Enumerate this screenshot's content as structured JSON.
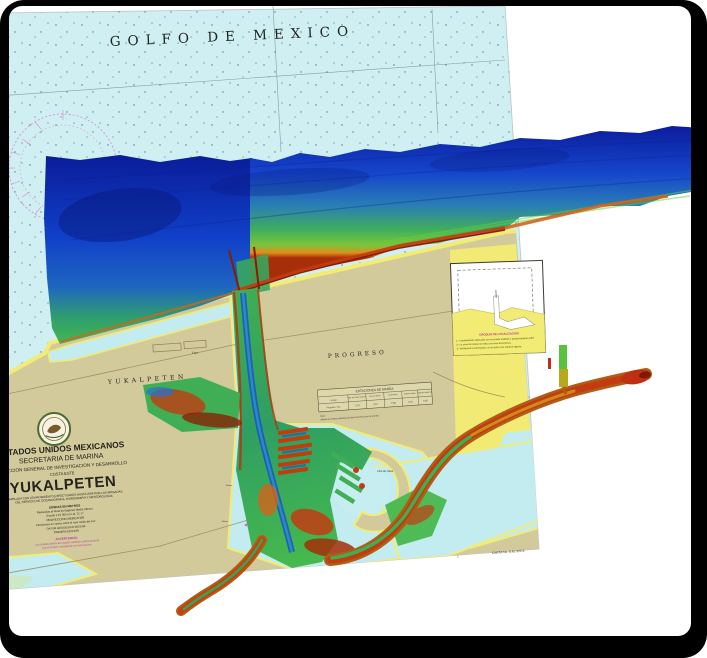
{
  "map": {
    "sea_label": "GOLFO DE MEXICO",
    "labels": {
      "yukalpeten": "YUKALPETEN",
      "progreso": "PROGRESO",
      "faro": "Faro",
      "club": "Club de Yates",
      "baliza1": "Baliza",
      "baliza2": "Baliza"
    },
    "title_block": {
      "country": "ESTADOS UNIDOS MEXICANOS",
      "agency": "SECRETARIA  DE  MARINA",
      "directorate": "DIRECCION GENERAL DE INVESTIGACION Y DESARROLLO",
      "region": "COSTA ESTE",
      "title": "YUKALPETEN",
      "subtitle1": "COMPILADA CON LEVANTAMIENTOS EFECTUADOS HASTA 2006 POR LAS BRIGADAS",
      "subtitle2": "DEL SERVICIO DE OCEANOGRAFIA, HIDROGRAFIA Y METEOROLOGIA",
      "notes": [
        "SONDAS EN METROS",
        "Reducidas al Nivel de Bajamar Media Inferior",
        "Escala 1:15 000 en Lat. 21 17",
        "PROYECCION MERCATOR",
        "Elevaciones en metros sobre el nivel medio del mar",
        "DATUM GEODESICO WGS-84",
        "PRIMERA EDICION"
      ],
      "warning": [
        "ADVERTENCIA:",
        "Las sondas dentro del puerto cambian continuamente",
        "por el azolve; naveguese con precaucion."
      ]
    },
    "tide_table": {
      "title": "ESTACIONES DE MAREA",
      "columns": [
        "LUGAR",
        "Plea. de Marea Superior",
        "Plea. de Marea",
        "Nivel Medio",
        "Bajamar Media",
        "Bajamar Media Inf."
      ],
      "row": [
        "Progreso, Yuc.",
        "0.76",
        "0.57",
        "0.38",
        "0.19",
        "0.00"
      ],
      "notes": [
        "Nota:",
        "Alturas en metros referidas al plano de reduccion de sondas."
      ]
    },
    "inset": {
      "title": "CROQUIS DE LOCALIZACION",
      "notes": [
        "1.- Levantamiento efectuado con ecosonda multihaz y posicionamiento GPS.",
        "2.- La zona de rastreo se indica con linea discontinua.",
        "3.- Verifiquese la informacion con el aviso a los marinos vigente."
      ]
    },
    "chart_number": "CARTA No. S.M. 922.3",
    "colors": {
      "water": "#cfeff2",
      "land": "#d3ca9b",
      "shoal_yellow": "#f2ec74",
      "marsh_green": "#cde8c4",
      "deep_blue": "#0c1e9e",
      "mid_green": "#3fae5c",
      "shallow_red": "#c23c10",
      "magenta": "#d966cc"
    }
  }
}
